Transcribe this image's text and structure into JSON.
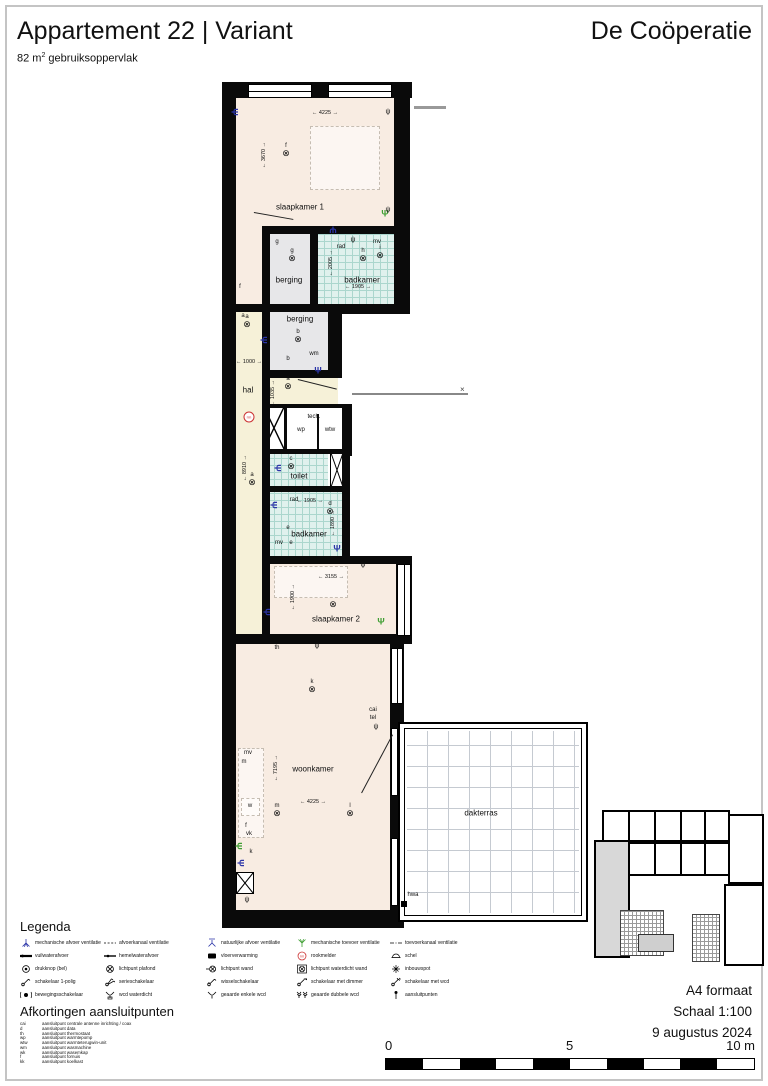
{
  "header": {
    "title": "Appartement 22 | Variant",
    "project": "De Coöperatie",
    "area": {
      "pre": "82 m",
      "sup": "2",
      "post": " gebruiksoppervlak"
    }
  },
  "plan": {
    "colors": {
      "vent_exhaust": "#2b35a8",
      "vent_supply": "#3f9e33",
      "smoke": "#cc3333"
    },
    "room_labels": [
      {
        "t": "slaapkamer 1",
        "x": 300,
        "y": 207
      },
      {
        "t": "berging",
        "x": 289,
        "y": 280
      },
      {
        "t": "badkamer",
        "x": 362,
        "y": 280
      },
      {
        "t": "berging",
        "x": 300,
        "y": 319
      },
      {
        "t": "hal",
        "x": 248,
        "y": 390
      },
      {
        "t": "toilet",
        "x": 299,
        "y": 476
      },
      {
        "t": "badkamer",
        "x": 309,
        "y": 534
      },
      {
        "t": "slaapkamer 2",
        "x": 336,
        "y": 619
      },
      {
        "t": "woonkamer",
        "x": 313,
        "y": 769
      },
      {
        "t": "dakterras",
        "x": 481,
        "y": 813
      }
    ],
    "annotations": [
      {
        "t": "rad",
        "x": 341,
        "y": 247
      },
      {
        "t": "mv",
        "x": 377,
        "y": 242
      },
      {
        "t": "tech.",
        "x": 314,
        "y": 417
      },
      {
        "t": "wp",
        "x": 301,
        "y": 430
      },
      {
        "t": "wtw",
        "x": 330,
        "y": 430
      },
      {
        "t": "wm",
        "x": 314,
        "y": 354
      },
      {
        "t": "rad",
        "x": 294,
        "y": 500
      },
      {
        "t": "e",
        "x": 288,
        "y": 528
      },
      {
        "t": "mv",
        "x": 279,
        "y": 543
      },
      {
        "t": "e",
        "x": 291,
        "y": 543
      },
      {
        "t": "th",
        "x": 277,
        "y": 648
      },
      {
        "t": "cai",
        "x": 373,
        "y": 710
      },
      {
        "t": "tel",
        "x": 373,
        "y": 718
      },
      {
        "t": "mv",
        "x": 248,
        "y": 753
      },
      {
        "t": "m",
        "x": 244,
        "y": 762
      },
      {
        "t": "w",
        "x": 250,
        "y": 806
      },
      {
        "t": "f",
        "x": 246,
        "y": 826
      },
      {
        "t": "vk",
        "x": 249,
        "y": 834
      },
      {
        "t": "k",
        "x": 251,
        "y": 852
      },
      {
        "t": "hwa",
        "x": 413,
        "y": 895
      },
      {
        "t": "f",
        "x": 240,
        "y": 287
      },
      {
        "t": "a",
        "x": 243,
        "y": 316
      },
      {
        "t": "b",
        "x": 288,
        "y": 359
      },
      {
        "t": "g",
        "x": 277,
        "y": 242
      }
    ],
    "lights": [
      {
        "l": "f",
        "x": 286,
        "y": 150
      },
      {
        "l": "g",
        "x": 292,
        "y": 255
      },
      {
        "l": "h",
        "x": 363,
        "y": 255
      },
      {
        "l": "i",
        "x": 380,
        "y": 252
      },
      {
        "l": "a",
        "x": 247,
        "y": 321
      },
      {
        "l": "b",
        "x": 298,
        "y": 336
      },
      {
        "l": "a",
        "x": 288,
        "y": 383
      },
      {
        "l": "c",
        "x": 291,
        "y": 463
      },
      {
        "l": "a",
        "x": 252,
        "y": 479
      },
      {
        "l": "d",
        "x": 330,
        "y": 508
      },
      {
        "l": "",
        "x": 333,
        "y": 604
      },
      {
        "l": "k",
        "x": 312,
        "y": 686
      },
      {
        "l": "m",
        "x": 277,
        "y": 810
      },
      {
        "l": "l",
        "x": 350,
        "y": 810
      }
    ],
    "dimensions": [
      {
        "t": "4225",
        "o": "h",
        "x": 325,
        "y": 113
      },
      {
        "t": "3670",
        "o": "v",
        "x": 264,
        "y": 155
      },
      {
        "t": "2005",
        "o": "v",
        "x": 331,
        "y": 263
      },
      {
        "t": "1905",
        "o": "h",
        "x": 358,
        "y": 287
      },
      {
        "t": "1000",
        "o": "h",
        "x": 249,
        "y": 362
      },
      {
        "t": "1035",
        "o": "v",
        "x": 273,
        "y": 393
      },
      {
        "t": "8910",
        "o": "v",
        "x": 245,
        "y": 468
      },
      {
        "t": "1905",
        "o": "h",
        "x": 310,
        "y": 501
      },
      {
        "t": "1890",
        "o": "v",
        "x": 333,
        "y": 523
      },
      {
        "t": "3155",
        "o": "h",
        "x": 331,
        "y": 577
      },
      {
        "t": "1900",
        "o": "v",
        "x": 293,
        "y": 597
      },
      {
        "t": "7195",
        "o": "v",
        "x": 276,
        "y": 768
      },
      {
        "t": "4225",
        "o": "h",
        "x": 313,
        "y": 802
      }
    ],
    "vents": [
      {
        "c": "exhaust",
        "x": 234,
        "y": 112,
        "r": 90
      },
      {
        "c": "exhaust",
        "x": 333,
        "y": 229,
        "r": 180
      },
      {
        "c": "supply",
        "x": 385,
        "y": 214,
        "r": 0
      },
      {
        "c": "exhaust",
        "x": 263,
        "y": 340,
        "r": 90
      },
      {
        "c": "exhaust",
        "x": 318,
        "y": 371,
        "r": 0
      },
      {
        "c": "exhaust",
        "x": 277,
        "y": 468,
        "r": 90
      },
      {
        "c": "exhaust",
        "x": 273,
        "y": 505,
        "r": 90
      },
      {
        "c": "exhaust",
        "x": 337,
        "y": 549,
        "r": 0
      },
      {
        "c": "exhaust",
        "x": 266,
        "y": 612,
        "r": 90
      },
      {
        "c": "supply",
        "x": 381,
        "y": 622,
        "r": 0
      },
      {
        "c": "supply",
        "x": 238,
        "y": 846,
        "r": 90
      },
      {
        "c": "exhaust",
        "x": 240,
        "y": 863,
        "r": 90
      }
    ],
    "sockets": [
      {
        "x": 388,
        "y": 112
      },
      {
        "x": 388,
        "y": 210
      },
      {
        "x": 353,
        "y": 240
      },
      {
        "x": 363,
        "y": 565
      },
      {
        "x": 317,
        "y": 646
      },
      {
        "x": 247,
        "y": 900
      },
      {
        "x": 376,
        "y": 727
      }
    ],
    "smoke_detector": {
      "x": 249,
      "y": 417,
      "label": "rm"
    }
  },
  "legend": {
    "title": "Legenda",
    "columns": [
      [
        {
          "icon": "vent_mech_afvoer",
          "label": "mechanische afvoer ventilatie"
        },
        {
          "icon": "vuilwater",
          "label": "vuilwaterafvoer"
        },
        {
          "icon": "drukknop",
          "label": "drukknop (bel)"
        },
        {
          "icon": "sw_1polig",
          "label": "schakelaar 1-polig"
        },
        {
          "icon": "sw_beweging",
          "label": "bewegingsschakelaar"
        }
      ],
      [
        {
          "icon": "kanaal_afvoer",
          "label": "afvoerkanaal ventilatie"
        },
        {
          "icon": "hemelwater",
          "label": "hemelwaterafvoer"
        },
        {
          "icon": "lp_plafond",
          "label": "lichtpunt plafond"
        },
        {
          "icon": "sw_serie",
          "label": "serieschakelaar"
        },
        {
          "icon": "wcd_waterdicht",
          "label": "wcd waterdicht"
        }
      ],
      [
        {
          "icon": "vent_nat_afvoer",
          "label": "natuurlijke afvoer ventilatie"
        },
        {
          "icon": "vloerverwarming",
          "label": "vloerverwarming"
        },
        {
          "icon": "lp_wand",
          "label": "lichtpunt wand"
        },
        {
          "icon": "sw_wissel",
          "label": "wisselschakelaar"
        },
        {
          "icon": "wcd_enkel",
          "label": "geaarde enkele wcd"
        }
      ],
      [
        {
          "icon": "vent_mech_toevoer",
          "label": "mechanische toevoer ventilatie"
        },
        {
          "icon": "rookmelder",
          "label": "rookmelder"
        },
        {
          "icon": "lp_waterdicht",
          "label": "lichtpunt waterdicht wand"
        },
        {
          "icon": "sw_dimmer",
          "label": "schakelaar met dimmer"
        },
        {
          "icon": "wcd_dubbel",
          "label": "geaarde dubbele wcd"
        }
      ],
      [
        {
          "icon": "kanaal_toevoer",
          "label": "toevoerkanaal ventilatie"
        },
        {
          "icon": "schel",
          "label": "schel"
        },
        {
          "icon": "inbouwspot",
          "label": "inbouwspot"
        },
        {
          "icon": "sw_wcd",
          "label": "schakelaar met wcd"
        },
        {
          "icon": "aansluitpunt",
          "label": "aansluitpunten"
        }
      ]
    ]
  },
  "abbreviations": {
    "title": "Afkortingen aansluitpunten",
    "items": [
      {
        "key": "cai",
        "desc": "aansluitpunt centrale antenne inrichting / coax"
      },
      {
        "key": "d",
        "desc": "aansluitpunt data"
      },
      {
        "key": "th",
        "desc": "aansluitpunt thermostaat"
      },
      {
        "key": "wp",
        "desc": "aansluitpunt warmtepomp"
      },
      {
        "key": "wtw",
        "desc": "aansluitpunt warmteterugwin-unit"
      },
      {
        "key": "wm",
        "desc": "aansluitpunt wasmachine"
      },
      {
        "key": "wk",
        "desc": "aansluitpunt wasemkap"
      },
      {
        "key": "f",
        "desc": "aansluitpunt fornuis"
      },
      {
        "key": "kk",
        "desc": "aansluitpunt koelkast"
      }
    ]
  },
  "footer": {
    "lines": [
      "A4 formaat",
      "Schaal 1:100",
      "9 augustus 2024"
    ]
  },
  "scalebar": {
    "start": "0",
    "mid": "5",
    "end": "10 m",
    "segments": 10
  }
}
